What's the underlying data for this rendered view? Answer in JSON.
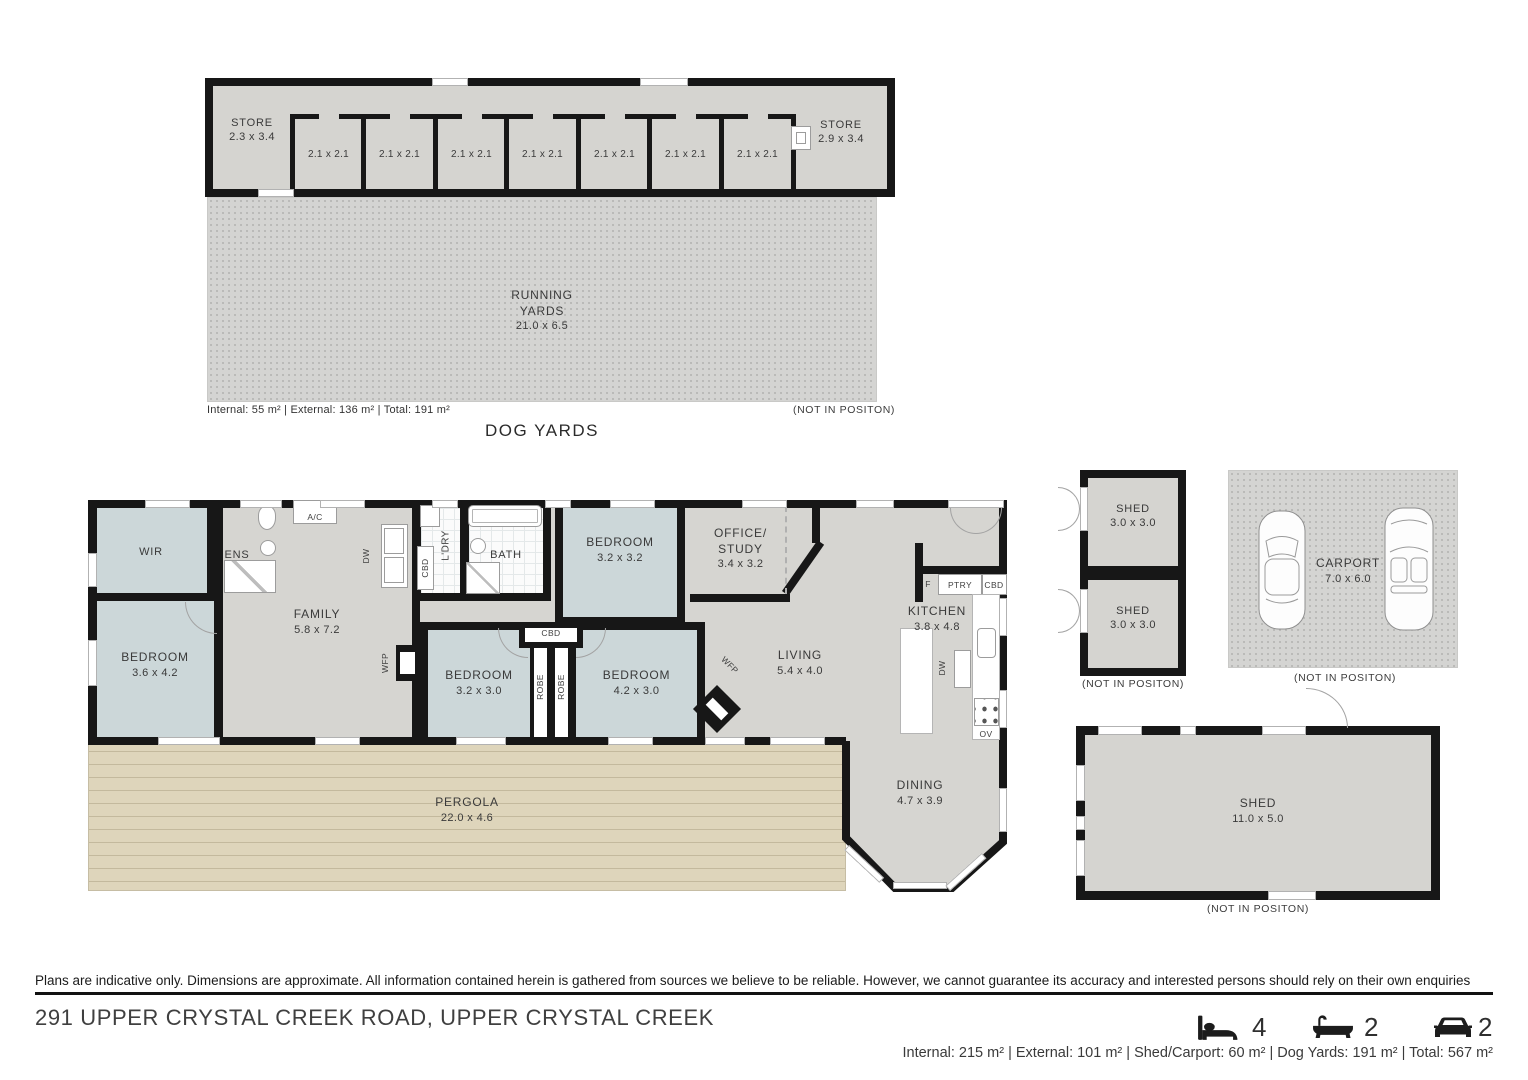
{
  "not_in_position": "(NOT IN POSITON)",
  "dog_yards": {
    "title": "DOG YARDS",
    "areas_line": "Internal: 55 m²    |    External: 136 m²    |    Total: 191 m²",
    "store_left": {
      "name": "STORE",
      "dims": "2.3 x 3.4"
    },
    "store_right": {
      "name": "STORE",
      "dims": "2.9 x 3.4"
    },
    "kennels": [
      "2.1 x 2.1",
      "2.1 x 2.1",
      "2.1 x 2.1",
      "2.1 x 2.1",
      "2.1 x 2.1",
      "2.1 x 2.1",
      "2.1 x 2.1"
    ],
    "running_yards": {
      "line1": "RUNNING",
      "line2": "YARDS",
      "dims": "21.0 x 6.5"
    }
  },
  "house": {
    "wir": "WIR",
    "ens": "ENS",
    "bedroom1": {
      "name": "BEDROOM",
      "dims": "3.6 x 4.2"
    },
    "family": {
      "name": "FAMILY",
      "dims": "5.8 x 7.2"
    },
    "ac": "A/C",
    "dw": "DW",
    "cbd": "CBD",
    "ldry": "L'DRY",
    "bath": "BATH",
    "bedroom2": {
      "name": "BEDROOM",
      "dims": "3.2 x 3.2"
    },
    "office": {
      "line1": "OFFICE/",
      "line2": "STUDY",
      "dims": "3.4 x 3.2"
    },
    "kitchen": {
      "name": "KITCHEN",
      "dims": "3.8 x 4.8"
    },
    "living": {
      "name": "LIVING",
      "dims": "5.4 x 4.0"
    },
    "bedroom3": {
      "name": "BEDROOM",
      "dims": "3.2 x 3.0"
    },
    "bedroom4": {
      "name": "BEDROOM",
      "dims": "4.2 x 3.0"
    },
    "dining": {
      "name": "DINING",
      "dims": "4.7 x 3.9"
    },
    "pergola": {
      "name": "PERGOLA",
      "dims": "22.0 x 4.6"
    },
    "robe": "ROBE",
    "wfp": "WFP",
    "fridge": "F",
    "pantry": "PTRY",
    "oven": "OV"
  },
  "outbuildings": {
    "shed_small": {
      "name": "SHED",
      "dims": "3.0 x 3.0"
    },
    "carport": {
      "name": "CARPORT",
      "dims": "7.0 x 6.0"
    },
    "shed_large": {
      "name": "SHED",
      "dims": "11.0 x 5.0"
    }
  },
  "footer": {
    "disclaimer": "Plans are indicative only. Dimensions are approximate. All information contained herein is gathered from sources we believe to be reliable. However, we cannot guarantee its accuracy and interested persons should rely on their own enquiries",
    "address": "291 UPPER CRYSTAL CREEK ROAD, UPPER CRYSTAL CREEK",
    "beds": "4",
    "baths": "2",
    "cars": "2",
    "areas_line": "Internal: 215 m² |   External: 101 m² |   Shed/Carport: 60 m² |   Dog Yards: 191 m² |   Total: 567 m²"
  }
}
